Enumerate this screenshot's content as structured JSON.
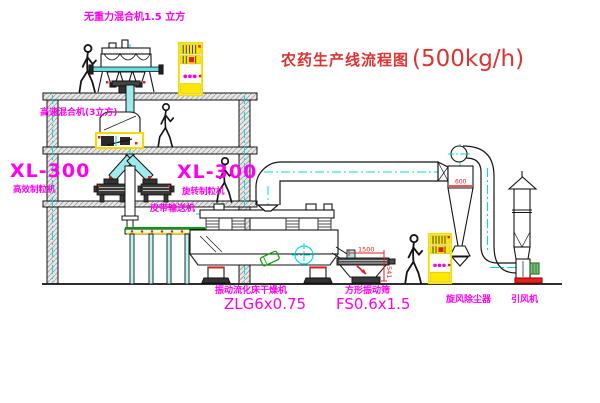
{
  "title": {
    "text_cn": "农药生产线流程图",
    "capacity": "(500kg/h)"
  },
  "equipment_labels": {
    "gravity_mixer": "无重力混合机1.5 立方",
    "high_speed_mixer": "高速混合机(3立方)",
    "granulator_left": {
      "model": "XL-300",
      "name": "高效制粒机"
    },
    "granulator_right": {
      "model": "XL-300",
      "name": "旋转制粒机"
    },
    "belt_conveyor": "皮带输送机",
    "fluid_bed_dryer": {
      "name": "振动流化床干燥机",
      "model": "ZLG6x0.75"
    },
    "vibrating_sieve": {
      "name": "方形振动筛",
      "model": "FS0.6x1.5"
    },
    "cyclone": "旋风除尘器",
    "fan": "引风机"
  },
  "dimensions": {
    "sieve_length": "1500",
    "sieve_height": "541",
    "cyclone_diameter": "600"
  },
  "colors": {
    "label_magenta": "#ff00ee",
    "title_red": "#dd3333",
    "dimension_red": "#e02020",
    "centerline_cyan": "#00dcdc",
    "cabinet_yellow": "#f0dc00",
    "conveyor_green": "#00a000",
    "background": "#ffffff"
  }
}
